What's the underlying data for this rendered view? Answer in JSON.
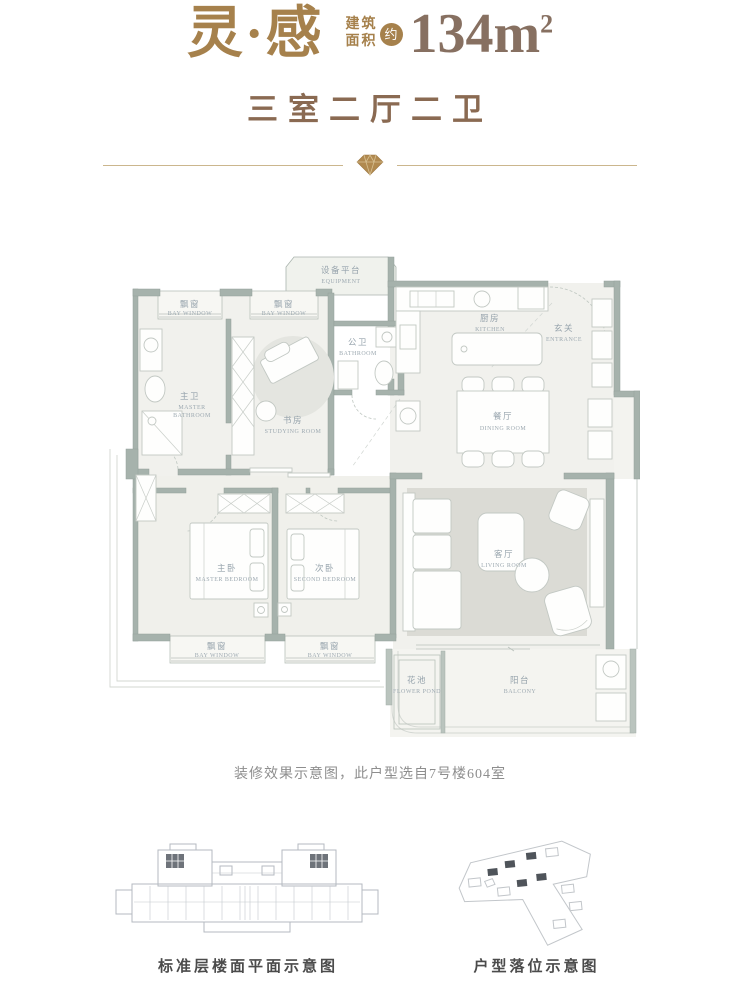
{
  "header": {
    "title": "灵·感",
    "area_label_line1": "建筑",
    "area_label_line2": "面积",
    "area_approx": "约",
    "area_value": "134m",
    "area_sup": "2",
    "subtitle": "三室二厅二卫"
  },
  "colors": {
    "gold": "#A6814C",
    "taupe": "#877061",
    "brown": "#8A6A52",
    "wall_sage": "#A6B2AC",
    "room_fill": "#F1F1ED",
    "rug_gray": "#DBDBD5",
    "plan_label": "#96A3AC",
    "divider_gold": "#CBB68D"
  },
  "plan": {
    "rooms": {
      "bay_window": {
        "cn": "飘窗",
        "en": "BAY WINDOW"
      },
      "equipment": {
        "cn": "设备平台",
        "en": "EQUIPMENT"
      },
      "kitchen": {
        "cn": "厨房",
        "en": "KITCHEN"
      },
      "entrance": {
        "cn": "玄关",
        "en": "ENTRANCE"
      },
      "public_bathroom": {
        "cn": "公卫",
        "en": "BATHROOM"
      },
      "master_bathroom": {
        "cn": "主卫",
        "en1": "MASTER",
        "en2": "BATHROOM"
      },
      "study": {
        "cn": "书房",
        "en": "STUDYING ROOM"
      },
      "dining": {
        "cn": "餐厅",
        "en": "DINING ROOM"
      },
      "master_bedroom": {
        "cn": "主卧",
        "en": "MASTER BEDROOM"
      },
      "second_bedroom": {
        "cn": "次卧",
        "en": "SECOND BEDROOM"
      },
      "living": {
        "cn": "客厅",
        "en": "LIVING ROOM"
      },
      "flower_pond": {
        "cn": "花池",
        "en": "FLOWER POND"
      },
      "balcony": {
        "cn": "阳台",
        "en": "BALCONY"
      }
    }
  },
  "caption": "装修效果示意图，此户型选自7号楼604室",
  "footer": {
    "left_caption": "标准层楼面平面示意图",
    "right_caption": "户型落位示意图"
  }
}
